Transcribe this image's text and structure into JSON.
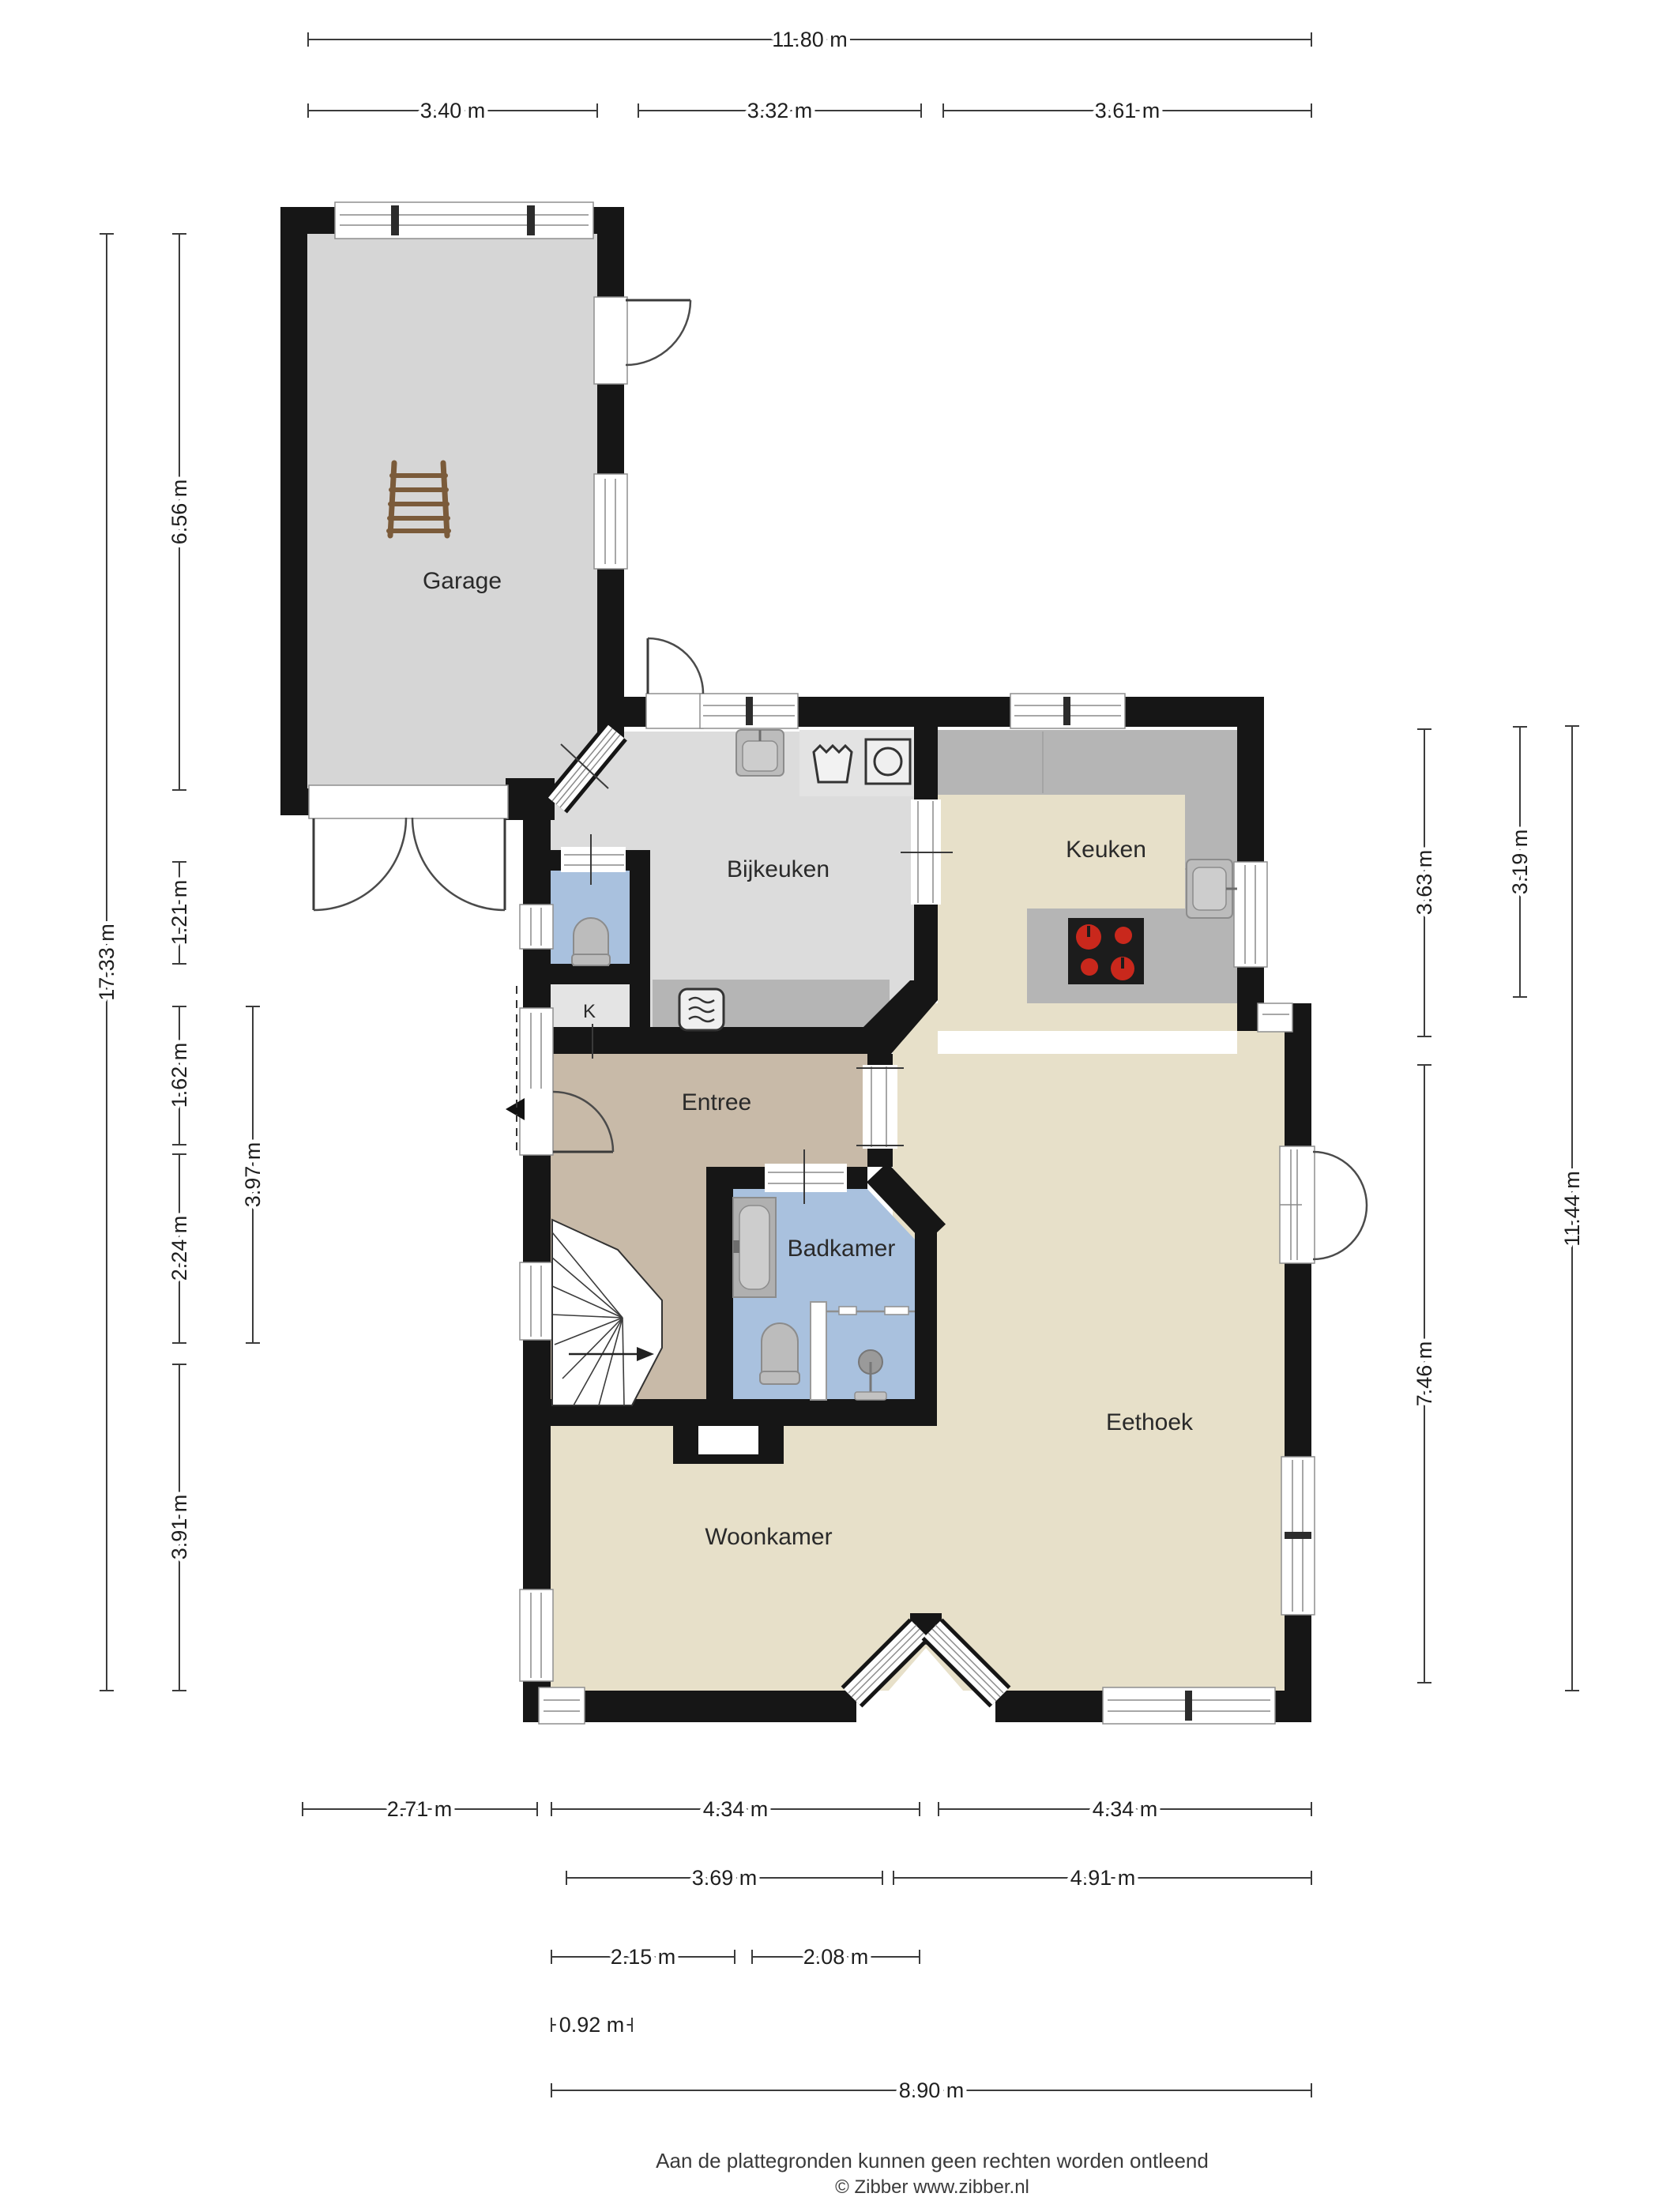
{
  "plan": {
    "rooms": {
      "garage": "Garage",
      "bijkeuken": "Bijkeuken",
      "keuken": "Keuken",
      "entree": "Entree",
      "badkamer": "Badkamer",
      "eethoek": "Eethoek",
      "woonkamer": "Woonkamer",
      "kast": "K"
    },
    "dimensions": {
      "top": [
        "11.80 m",
        "3.40 m",
        "3.32 m",
        "3.61 m"
      ],
      "left": [
        "17.33 m",
        "6.56 m",
        "1.21 m",
        "1.62 m",
        "2.24 m",
        "3.97 m",
        "3.91 m"
      ],
      "right": [
        "3.63 m",
        "3.19 m",
        "11.44 m",
        "7.46 m"
      ],
      "bottom": [
        "2.71 m",
        "4.34 m",
        "4.34 m",
        "3.69 m",
        "4.91 m",
        "2.15 m",
        "2.08 m",
        "0.92 m",
        "8.90 m"
      ]
    },
    "footer": {
      "line1": "Aan de plattegronden kunnen geen rechten worden ontleend",
      "line2": "© Zibber www.zibber.nl"
    },
    "icons": {
      "ladder": "ladder-icon",
      "washing_machine": "washing-machine-icon",
      "laundry_basket": "laundry-basket-icon",
      "microwave": "microwave-icon",
      "sink": "sink-icon",
      "cooktop": "cooktop-icon",
      "toilet": "toilet-icon",
      "bathtub": "bathtub-icon",
      "shower": "shower-icon",
      "stairs": "stairs-icon",
      "entrance_arrow": "entrance-arrow-icon"
    },
    "palette": {
      "wall": "#161616",
      "floor_garage": "#d6d6d6",
      "floor_bijkeuken": "#dcdcdc",
      "floor_living": "#e7e0c9",
      "floor_entree": "#c8baa8",
      "floor_bath": "#a9c1de",
      "floor_closet": "#e4e4e4",
      "counter": "#b5b5b5",
      "appliance_block": "#e3e3e3",
      "stove": "#1c1c1c",
      "burner": "#c9281c",
      "ladder": "#7b5b3a",
      "dim_line": "#3c3c3c",
      "text": "#1f1f1f"
    }
  }
}
